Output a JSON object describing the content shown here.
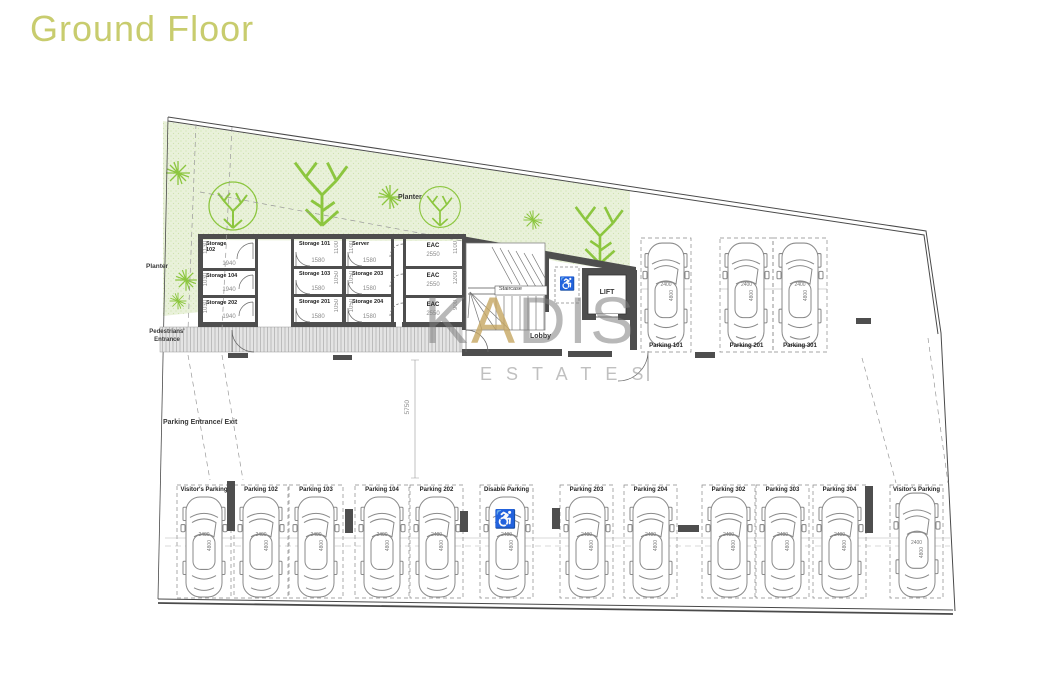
{
  "title": {
    "text": "Ground Floor"
  },
  "watermark": {
    "brand_pre": "K",
    "brand_accent": "A",
    "brand_post": "DIS",
    "sub": "ESTATES"
  },
  "icons": {
    "wheelchair": "♿"
  },
  "labels": {
    "planter_top": "Planter",
    "planter_left": "Planter",
    "pedestrians_entrance": "Pedestrians' Entrance",
    "parking_entrance": "Parking Entrance/ Exit",
    "staircase": "Staircase",
    "lobby": "Lobby",
    "lift": "LIFT",
    "aisle_dim": "5750"
  },
  "storage_rooms": [
    {
      "name": "Storage",
      "number": "102",
      "w": "1940",
      "h": "1130"
    },
    {
      "name": "Storage",
      "number": "104",
      "w": "1940",
      "h": "1030"
    },
    {
      "name": "Storage",
      "number": "202",
      "w": "1940",
      "h": "1030"
    },
    {
      "name": "Storage",
      "number": "101",
      "w": "1580",
      "h": "1100"
    },
    {
      "name": "Storage",
      "number": "103",
      "w": "1580",
      "h": "1050"
    },
    {
      "name": "Storage",
      "number": "201",
      "w": "1580",
      "h": "1050"
    },
    {
      "name": "Server",
      "number": "",
      "w": "1580",
      "h": "1100"
    },
    {
      "name": "Storage",
      "number": "203",
      "w": "1580",
      "h": "1050"
    },
    {
      "name": "Storage",
      "number": "204",
      "w": "1580",
      "h": "1050"
    }
  ],
  "eac_rooms": [
    {
      "name": "EAC",
      "w": "2550",
      "h": "1100"
    },
    {
      "name": "EAC",
      "w": "2550",
      "h": "1200"
    },
    {
      "name": "EAC",
      "w": "2550",
      "h": "900"
    }
  ],
  "parking_top": [
    {
      "label": "Parking 101",
      "w": "2400",
      "l": "4800"
    },
    {
      "label": "Parking 201",
      "w": "2400",
      "l": "4800"
    },
    {
      "label": "Parking 301",
      "w": "2400",
      "l": "4800"
    }
  ],
  "parking_bottom": [
    {
      "label": "Visitor's Parking",
      "w": "2400",
      "l": "4800"
    },
    {
      "label": "Parking 102",
      "w": "2400",
      "l": "4800"
    },
    {
      "label": "Parking 103",
      "w": "2400",
      "l": "4800"
    },
    {
      "label": "Parking 104",
      "w": "2400",
      "l": "4800"
    },
    {
      "label": "Parking 202",
      "w": "2400",
      "l": "4800"
    },
    {
      "label": "Disable Parking",
      "w": "2400",
      "l": "4800"
    },
    {
      "label": "Parking 203",
      "w": "2400",
      "l": "4800"
    },
    {
      "label": "Parking 204",
      "w": "2400",
      "l": "4800"
    },
    {
      "label": "Parking 302",
      "w": "2400",
      "l": "4800"
    },
    {
      "label": "Parking 303",
      "w": "2400",
      "l": "4800"
    },
    {
      "label": "Parking 304",
      "w": "2400",
      "l": "4800"
    },
    {
      "label": "Visitor's Parking",
      "w": "2400",
      "l": "4800"
    }
  ]
}
